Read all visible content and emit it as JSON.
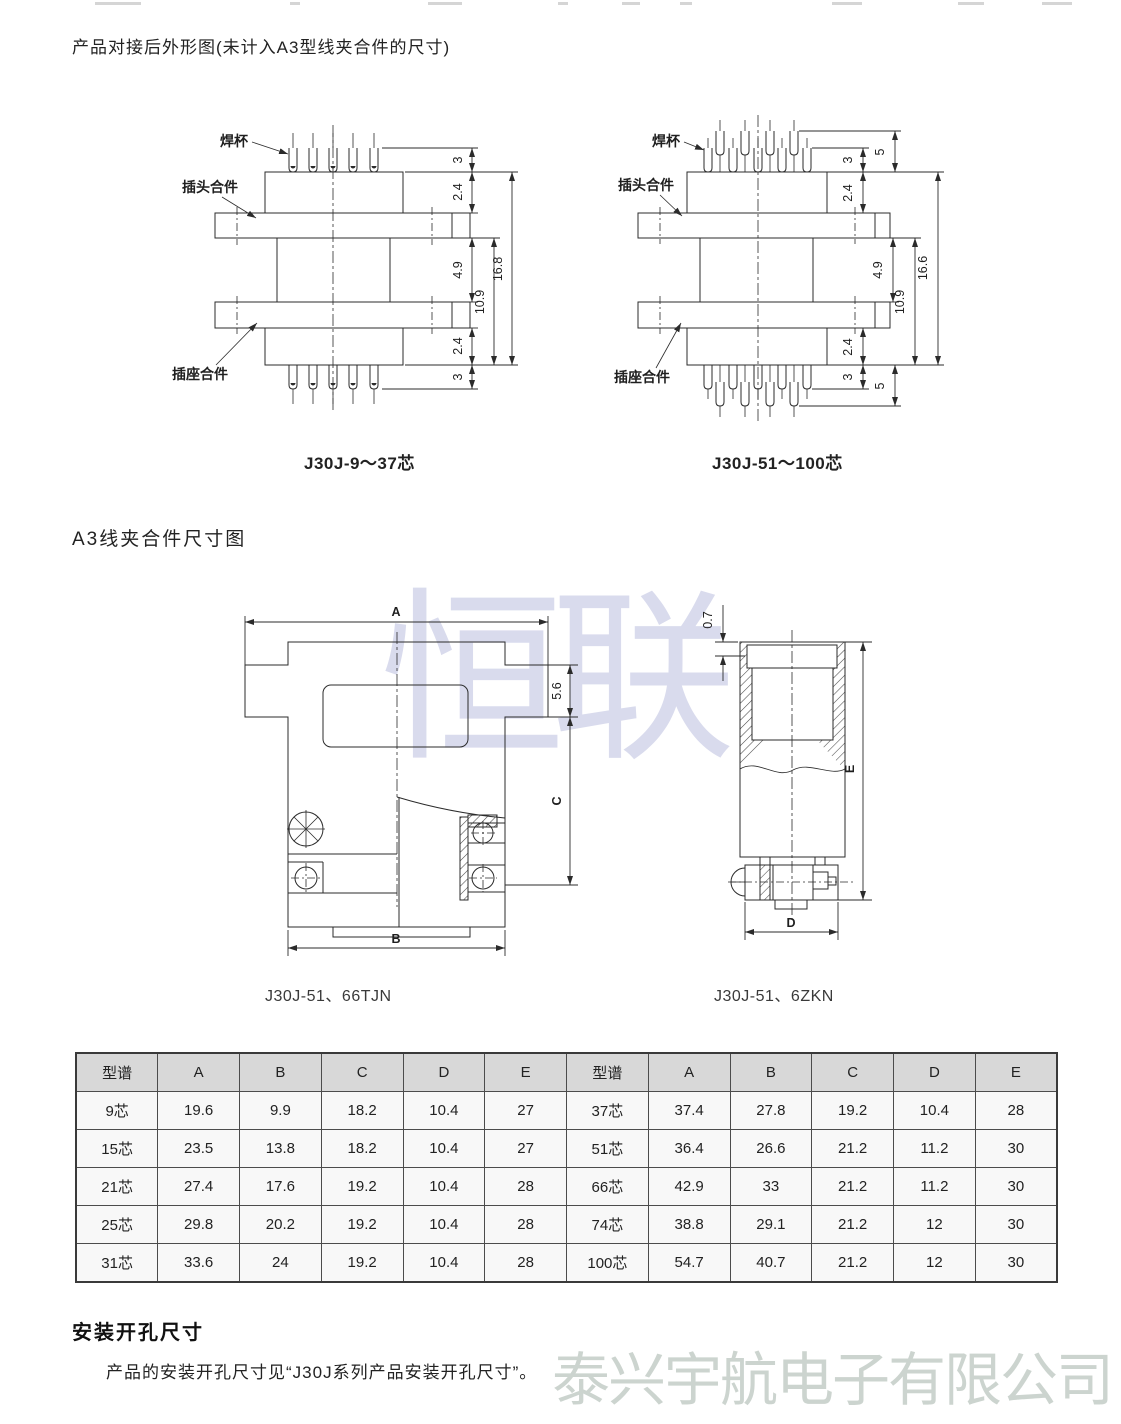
{
  "section1": {
    "title": "产品对接后外形图(未计入A3型线夹合件的尺寸)",
    "left_drawing": {
      "caption": "J30J-9～37芯",
      "labels": {
        "solder_cup": "焊杯",
        "plug": "插头合件",
        "socket": "插座合件"
      },
      "dims": {
        "pin_top": "3",
        "body_top": "2.4",
        "gap": "4.9",
        "inner": "10.9",
        "total": "16.8",
        "body_bottom": "2.4",
        "pin_bottom": "3"
      }
    },
    "right_drawing": {
      "caption": "J30J-51～100芯",
      "labels": {
        "solder_cup": "焊杯",
        "plug": "插头合件",
        "socket": "插座合件"
      },
      "dims": {
        "pin_top": "3",
        "pin_top_outer": "5",
        "body_top": "2.4",
        "gap": "4.9",
        "inner": "10.9",
        "total": "16.6",
        "body_bottom": "2.4",
        "pin_bottom": "3",
        "pin_bottom_outer": "5"
      }
    }
  },
  "section2": {
    "title": "A3线夹合件尺寸图",
    "front_view": {
      "caption": "J30J-51、66TJN",
      "dims": {
        "a": "A",
        "b": "B",
        "c": "C",
        "lip": "5.6"
      }
    },
    "side_view": {
      "caption": "J30J-51、6ZKN",
      "dims": {
        "d": "D",
        "e": "E",
        "lip": "0.7"
      }
    }
  },
  "table": {
    "header": [
      "型谱",
      "A",
      "B",
      "C",
      "D",
      "E",
      "型谱",
      "A",
      "B",
      "C",
      "D",
      "E"
    ],
    "rows": [
      [
        "9芯",
        "19.6",
        "9.9",
        "18.2",
        "10.4",
        "27",
        "37芯",
        "37.4",
        "27.8",
        "19.2",
        "10.4",
        "28"
      ],
      [
        "15芯",
        "23.5",
        "13.8",
        "18.2",
        "10.4",
        "27",
        "51芯",
        "36.4",
        "26.6",
        "21.2",
        "11.2",
        "30"
      ],
      [
        "21芯",
        "27.4",
        "17.6",
        "19.2",
        "10.4",
        "28",
        "66芯",
        "42.9",
        "33",
        "21.2",
        "11.2",
        "30"
      ],
      [
        "25芯",
        "29.8",
        "20.2",
        "19.2",
        "10.4",
        "28",
        "74芯",
        "38.8",
        "29.1",
        "21.2",
        "12",
        "30"
      ],
      [
        "31芯",
        "33.6",
        "24",
        "19.2",
        "10.4",
        "28",
        "100芯",
        "54.7",
        "40.7",
        "21.2",
        "12",
        "30"
      ]
    ]
  },
  "section3": {
    "title": "安装开孔尺寸",
    "body": "产品的安装开孔尺寸见“J30J系列产品安装开孔尺寸”。"
  },
  "watermarks": {
    "center": "恒联",
    "bottom": "泰兴宇航电子有限公司"
  }
}
